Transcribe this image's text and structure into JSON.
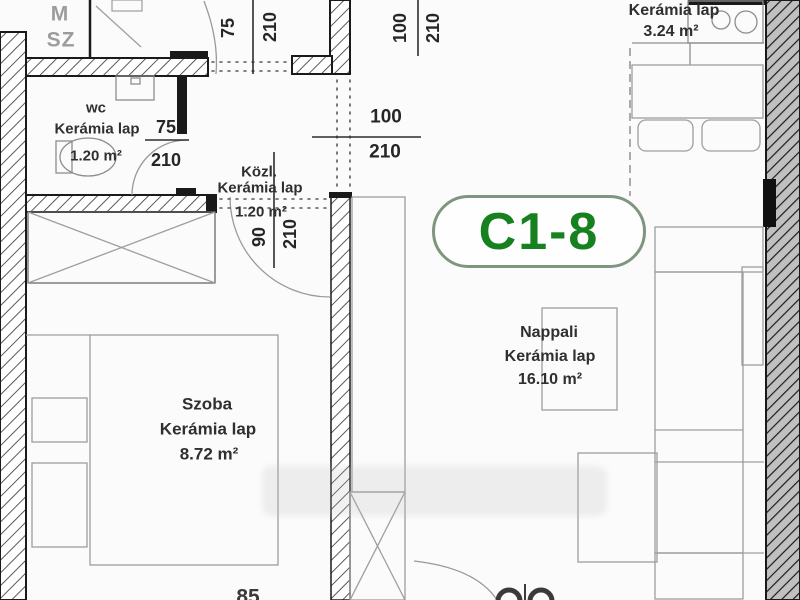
{
  "unit": {
    "badge": "C1-8"
  },
  "colors": {
    "badge_green": "#17801f",
    "badge_border": "#80957f",
    "wall_line": "#1a1a1a",
    "furniture_line": "#9e9e9e",
    "label_text": "#2f2f2f",
    "neighbor_text": "#9c9c9c"
  },
  "rooms": {
    "wc": {
      "name": "wc",
      "material": "Kerámia lap",
      "area": "1.20 m²"
    },
    "kozl": {
      "name": "Közl.",
      "material": "Kerámia lap",
      "area": "1.20 m²"
    },
    "szoba": {
      "name": "Szoba",
      "material": "Kerámia lap",
      "area": "8.72 m²"
    },
    "nappali": {
      "name": "Nappali",
      "material": "Kerámia lap",
      "area": "16.10 m²"
    },
    "konyha": {
      "material": "Kerámia lap",
      "area": "3.24 m²"
    }
  },
  "dims": {
    "entry_top": {
      "w": "75",
      "h": "210"
    },
    "top_center": {
      "w": "100",
      "h": "210"
    },
    "kozl_pass": {
      "w": "100",
      "h": "210"
    },
    "wc_door": {
      "w": "75",
      "h": "210"
    },
    "szoba_door": {
      "w": "90",
      "h": "210"
    }
  },
  "neighbor": {
    "line1": "M",
    "line2": "SZ"
  },
  "clipped": {
    "bottom_left": "85"
  }
}
